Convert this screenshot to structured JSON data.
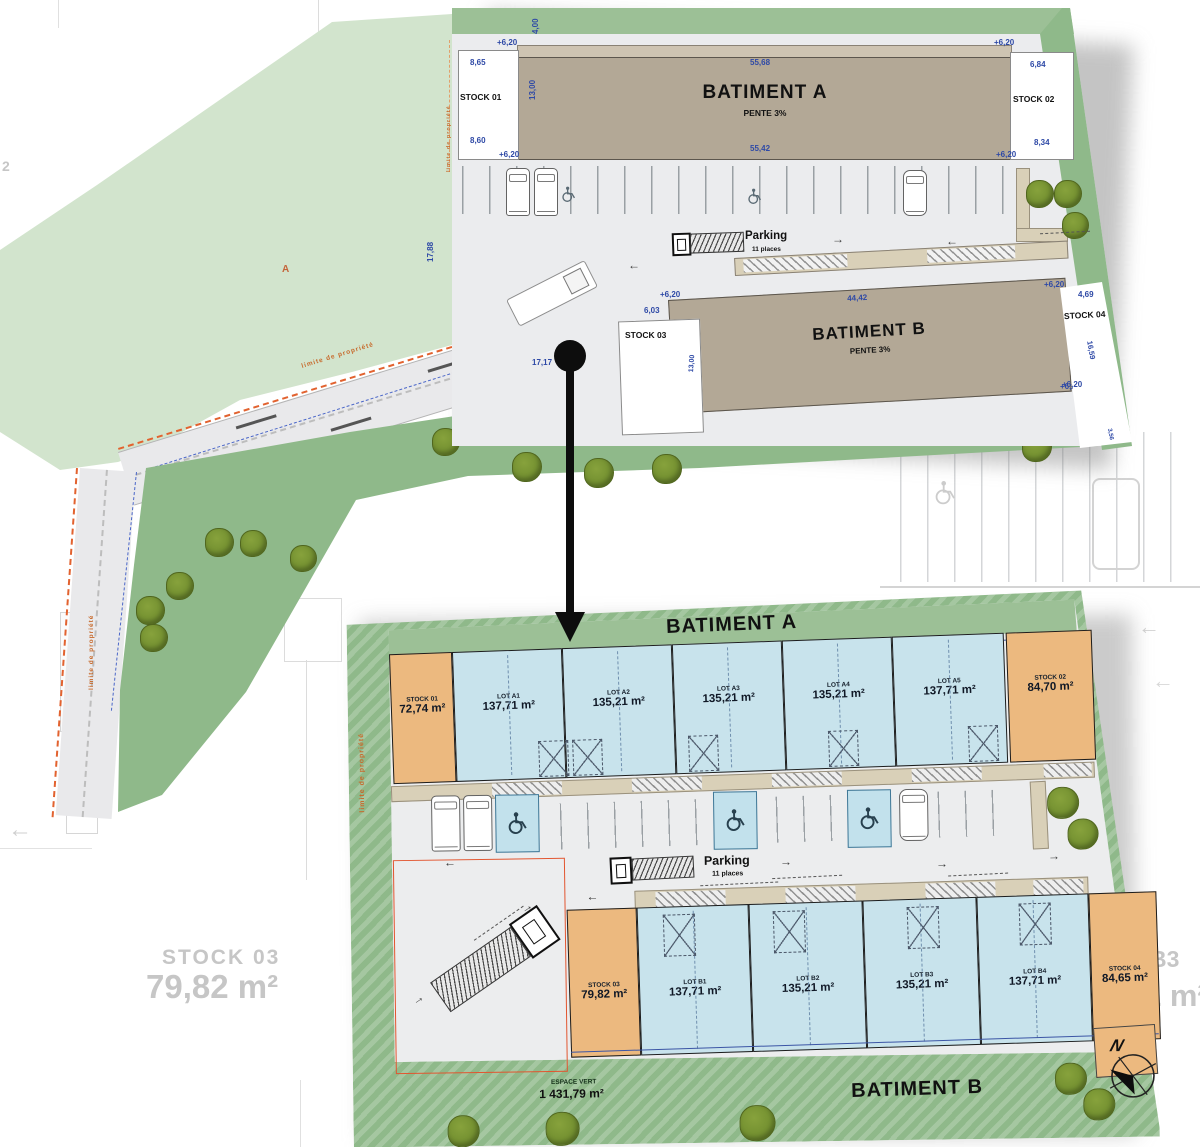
{
  "icons": {
    "arrow_left": "←",
    "arrow_right": "→"
  },
  "background": {
    "stock03_name": "STOCK 03",
    "stock03_area": "79,82 m²",
    "label_b3": "B3",
    "label_m2": "1 m²",
    "faint_digit": "2"
  },
  "top_plan": {
    "level": "+6,20",
    "limite_label": "limite de propriété",
    "marker_a": "A",
    "stock01": {
      "name": "STOCK 01",
      "dim_top": "8,65",
      "dim_bottom": "8,60",
      "dim_height": "13,00",
      "dim_width": "4,00"
    },
    "batimentA": {
      "name": "BATIMENT A",
      "slope": "PENTE 3%",
      "dim_top": "55,68",
      "dim_bottom": "55,42"
    },
    "stock02": {
      "name": "STOCK 02",
      "dim_top": "6,84",
      "dim_bottom": "8,34"
    },
    "parking": {
      "label": "Parking",
      "places": "11 places"
    },
    "batimentB": {
      "name": "BATIMENT B",
      "slope": "PENTE 3%",
      "dim_top": "44,42"
    },
    "stock03": {
      "name": "STOCK 03",
      "dim_top": "6,03",
      "dim_height": "13,00"
    },
    "stock04": {
      "name": "STOCK 04",
      "dim_top": "4,69",
      "dim_side": "16,59",
      "dim_bottom": "3,56"
    },
    "dims": {
      "left_height": "17,88",
      "entry_width": "17,17",
      "road_width": "5,00"
    }
  },
  "detail_plan": {
    "batimentA_title": "BATIMENT A",
    "batimentB_title": "BATIMENT B",
    "limite_label": "limite de propriété",
    "north": "N",
    "parking": {
      "label": "Parking",
      "places": "11 places"
    },
    "espace_vert": {
      "label": "ESPACE VERT",
      "area": "1 431,79 m²"
    },
    "rowA": [
      {
        "name": "STOCK 01",
        "area": "72,74 m²"
      },
      {
        "name": "LOT A1",
        "area": "137,71 m²"
      },
      {
        "name": "LOT A2",
        "area": "135,21 m²"
      },
      {
        "name": "LOT A3",
        "area": "135,21 m²"
      },
      {
        "name": "LOT A4",
        "area": "135,21 m²"
      },
      {
        "name": "LOT A5",
        "area": "137,71 m²"
      },
      {
        "name": "STOCK 02",
        "area": "84,70 m²"
      }
    ],
    "rowB": [
      {
        "name": "STOCK 03",
        "area": "79,82 m²"
      },
      {
        "name": "LOT B1",
        "area": "137,71 m²"
      },
      {
        "name": "LOT B2",
        "area": "135,21 m²"
      },
      {
        "name": "LOT B3",
        "area": "135,21 m²"
      },
      {
        "name": "LOT B4",
        "area": "137,71 m²"
      },
      {
        "name": "STOCK 04",
        "area": "84,65 m²"
      }
    ]
  }
}
